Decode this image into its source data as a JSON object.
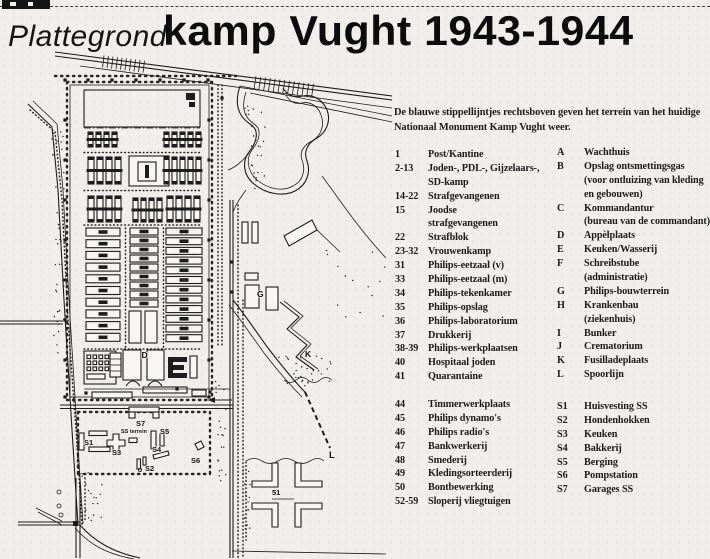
{
  "colors": {
    "paper": "#f0efeb",
    "ink": "#1d1d1d"
  },
  "title": {
    "prefix": "Plattegrond",
    "main": "kamp Vught 1943-1944"
  },
  "intro": {
    "line1": "De blauwe stippellijntjes rechtsboven geven het terrein van het huidige",
    "line2": "Nationaal Monument Kamp Vught weer."
  },
  "legend": {
    "numbers": [
      {
        "k": "1",
        "t": "Post/Kantine"
      },
      {
        "k": "2-13",
        "t": "Joden-, PDL-, Gijzelaars-,"
      },
      {
        "k": "",
        "t": "SD-kamp"
      },
      {
        "k": "14-22",
        "t": "Strafgevangenen"
      },
      {
        "k": "15",
        "t": "Joodse"
      },
      {
        "k": "",
        "t": "strafgevangenen"
      },
      {
        "k": "22",
        "t": "Strafblok"
      },
      {
        "k": "23-32",
        "t": "Vrouwenkamp"
      },
      {
        "k": "31",
        "t": "Philips-eetzaal (v)"
      },
      {
        "k": "33",
        "t": "Philips-eetzaal (m)"
      },
      {
        "k": "34",
        "t": "Philips-tekenkamer"
      },
      {
        "k": "35",
        "t": "Philips-opslag"
      },
      {
        "k": "36",
        "t": "Philips-laboratorium"
      },
      {
        "k": "37",
        "t": "Drukkerij"
      },
      {
        "k": "38-39",
        "t": "Philips-werkplaatsen"
      },
      {
        "k": "40",
        "t": "Hospitaal joden"
      },
      {
        "k": "41",
        "t": "Quarantaine"
      }
    ],
    "numbers2": [
      {
        "k": "44",
        "t": "Timmerwerkplaats"
      },
      {
        "k": "45",
        "t": "Philips dynamo's"
      },
      {
        "k": "46",
        "t": "Philips radio's"
      },
      {
        "k": "47",
        "t": "Bankwerkerij"
      },
      {
        "k": "48",
        "t": "Smederij"
      },
      {
        "k": "49",
        "t": "Kledingsorteerderij"
      },
      {
        "k": "50",
        "t": "Bontbewerking"
      },
      {
        "k": "52-59",
        "t": "Sloperij vliegtuigen"
      }
    ],
    "letters": [
      {
        "k": "A",
        "t": "Wachthuis"
      },
      {
        "k": "B",
        "t": "Opslag ontsmettingsgas"
      },
      {
        "k": "",
        "t": "(voor ontluizing van kleding"
      },
      {
        "k": "",
        "t": "en gebouwen)"
      },
      {
        "k": "C",
        "t": "Kommandantur"
      },
      {
        "k": "",
        "t": "(bureau van de commandant)"
      },
      {
        "k": "D",
        "t": "Appèlplaats"
      },
      {
        "k": "E",
        "t": "Keuken/Wasserij"
      },
      {
        "k": "F",
        "t": "Schreibstube"
      },
      {
        "k": "",
        "t": "(administratie)"
      },
      {
        "k": "G",
        "t": "Philips-bouwterrein"
      },
      {
        "k": "H",
        "t": "Krankenbau"
      },
      {
        "k": "",
        "t": "(ziekenhuis)"
      },
      {
        "k": "I",
        "t": "Bunker"
      },
      {
        "k": "J",
        "t": "Crematorium"
      },
      {
        "k": "K",
        "t": "Fusilladeplaats"
      },
      {
        "k": "L",
        "t": "Spoorlijn"
      }
    ],
    "letters2": [
      {
        "k": "S1",
        "t": "Huisvesting SS"
      },
      {
        "k": "S2",
        "t": "Hondenhokken"
      },
      {
        "k": "S3",
        "t": "Keuken"
      },
      {
        "k": "S4",
        "t": "Bakkerij"
      },
      {
        "k": "S5",
        "t": "Berging"
      },
      {
        "k": "S6",
        "t": "Pompstation"
      },
      {
        "k": "S7",
        "t": "Garages SS"
      }
    ]
  },
  "map": {
    "labels": [
      {
        "t": "D",
        "x": 141.5,
        "y": 358,
        "s": 8.5
      },
      {
        "t": "G",
        "x": 257,
        "y": 297,
        "s": 8.5
      },
      {
        "t": "K",
        "x": 305,
        "y": 357,
        "s": 8.5
      },
      {
        "t": "L",
        "x": 329,
        "y": 458,
        "s": 9.5
      },
      {
        "t": "S1",
        "x": 84,
        "y": 445,
        "s": 7.5
      },
      {
        "t": "S3",
        "x": 112,
        "y": 455,
        "s": 7.5
      },
      {
        "t": "S7",
        "x": 136,
        "y": 426,
        "s": 7.5
      },
      {
        "t": "SS terrein",
        "x": 121,
        "y": 433,
        "s": 5.5
      },
      {
        "t": "S5",
        "x": 160,
        "y": 434,
        "s": 7.5
      },
      {
        "t": "S4",
        "x": 152,
        "y": 452,
        "s": 7.5
      },
      {
        "t": "S6",
        "x": 191,
        "y": 463,
        "s": 7.5
      },
      {
        "t": "S2",
        "x": 145,
        "y": 471,
        "s": 7.5
      },
      {
        "t": "51",
        "x": 272,
        "y": 495,
        "s": 7.5
      }
    ]
  }
}
